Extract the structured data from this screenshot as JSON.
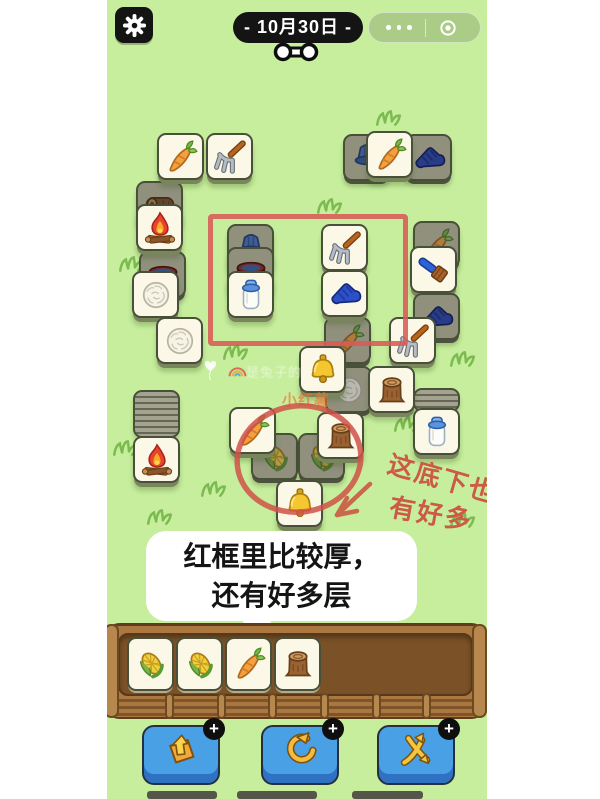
{
  "header": {
    "date_label": "- 10月30日 -",
    "settings_icon": "gear",
    "capsule": {
      "more_icon": "more-dots",
      "home_icon": "record-circle"
    }
  },
  "board": {
    "tiles": [
      {
        "icon": "log",
        "x": 29,
        "y": 181,
        "covered": true
      },
      {
        "icon": "bowl",
        "x": 32,
        "y": 251,
        "covered": true
      },
      {
        "icon": "fire",
        "x": 29,
        "y": 204,
        "covered": false
      },
      {
        "icon": "wool",
        "x": 25,
        "y": 271,
        "covered": false
      },
      {
        "icon": "wool",
        "x": 49,
        "y": 317,
        "covered": false
      },
      {
        "icon": "carrot",
        "x": 50,
        "y": 133,
        "covered": false
      },
      {
        "icon": "fork",
        "x": 99,
        "y": 133,
        "covered": false
      },
      {
        "icon": "bucket",
        "x": 236,
        "y": 134,
        "covered": true
      },
      {
        "icon": "glove",
        "x": 298,
        "y": 134,
        "covered": true
      },
      {
        "icon": "carrot",
        "x": 259,
        "y": 131,
        "covered": false
      },
      {
        "icon": "bucket",
        "x": 120,
        "y": 224,
        "covered": true
      },
      {
        "icon": "bowl",
        "x": 120,
        "y": 247,
        "covered": true
      },
      {
        "icon": "milk",
        "x": 120,
        "y": 271,
        "covered": false
      },
      {
        "icon": "fork",
        "x": 214,
        "y": 224,
        "covered": false
      },
      {
        "icon": "carrot",
        "x": 217,
        "y": 317,
        "covered": true
      },
      {
        "icon": "glove",
        "x": 214,
        "y": 270,
        "covered": false
      },
      {
        "icon": "carrot",
        "x": 306,
        "y": 221,
        "covered": true
      },
      {
        "icon": "brush",
        "x": 303,
        "y": 246,
        "covered": false
      },
      {
        "icon": "glove",
        "x": 306,
        "y": 293,
        "covered": true
      },
      {
        "icon": "fork",
        "x": 282,
        "y": 317,
        "covered": false
      },
      {
        "icon": "wool",
        "x": 218,
        "y": 366,
        "covered": true
      },
      {
        "icon": "bell",
        "x": 192,
        "y": 346,
        "covered": false
      },
      {
        "icon": "stump",
        "x": 261,
        "y": 366,
        "covered": false
      },
      {
        "icon": "corn",
        "x": 144,
        "y": 433,
        "covered": true
      },
      {
        "icon": "corn",
        "x": 191,
        "y": 433,
        "covered": true
      },
      {
        "icon": "carrot",
        "x": 122,
        "y": 407,
        "covered": false
      },
      {
        "icon": "stump",
        "x": 210,
        "y": 412,
        "covered": false
      },
      {
        "icon": "bell",
        "x": 169,
        "y": 480,
        "covered": false
      },
      {
        "icon": "fire",
        "x": 26,
        "y": 436,
        "covered": false
      },
      {
        "icon": "milk",
        "x": 306,
        "y": 408,
        "covered": false
      }
    ],
    "piles": [
      {
        "x": 26,
        "y": 390,
        "w": 47,
        "h": 48
      },
      {
        "x": 306,
        "y": 388,
        "w": 47,
        "h": 24
      }
    ],
    "grass": [
      {
        "x": 268,
        "y": 110
      },
      {
        "x": 209,
        "y": 198
      },
      {
        "x": 11,
        "y": 256
      },
      {
        "x": 115,
        "y": 344
      },
      {
        "x": 342,
        "y": 351
      },
      {
        "x": 286,
        "y": 416
      },
      {
        "x": 5,
        "y": 440
      },
      {
        "x": 93,
        "y": 481
      },
      {
        "x": 39,
        "y": 509
      },
      {
        "x": 342,
        "y": 512
      }
    ]
  },
  "annotations": {
    "note_line1": "这底下也还",
    "note_line2": "有好多",
    "bubble_line1": "红框里比较厚，",
    "bubble_line2": "还有好多层",
    "accent_color": "#d85b55"
  },
  "watermark": {
    "heart_icon": "heart-balloon",
    "rainbow_icon": "rainbow",
    "name": "是兔子的",
    "badge": "小红薯"
  },
  "tray": {
    "tiles": [
      "corn",
      "corn",
      "carrot",
      "stump"
    ]
  },
  "toolbar": {
    "badge_label": "+",
    "buttons": [
      {
        "name": "remove-three-button",
        "icon": "bag-out",
        "x": 35
      },
      {
        "name": "undo-button",
        "icon": "undo-arrow",
        "x": 154
      },
      {
        "name": "shuffle-button",
        "icon": "shuffle-arrows",
        "x": 270
      }
    ]
  },
  "colors": {
    "background_green": "#c7ee9d",
    "tile_face": "#fcf8e8",
    "tile_covered": "#90907d",
    "tray_wood": "#aa7840",
    "tray_inner": "#7b5228",
    "button_blue": "#4aa0e4",
    "annotation_red": "#d85b55",
    "pill_black": "#141414"
  }
}
